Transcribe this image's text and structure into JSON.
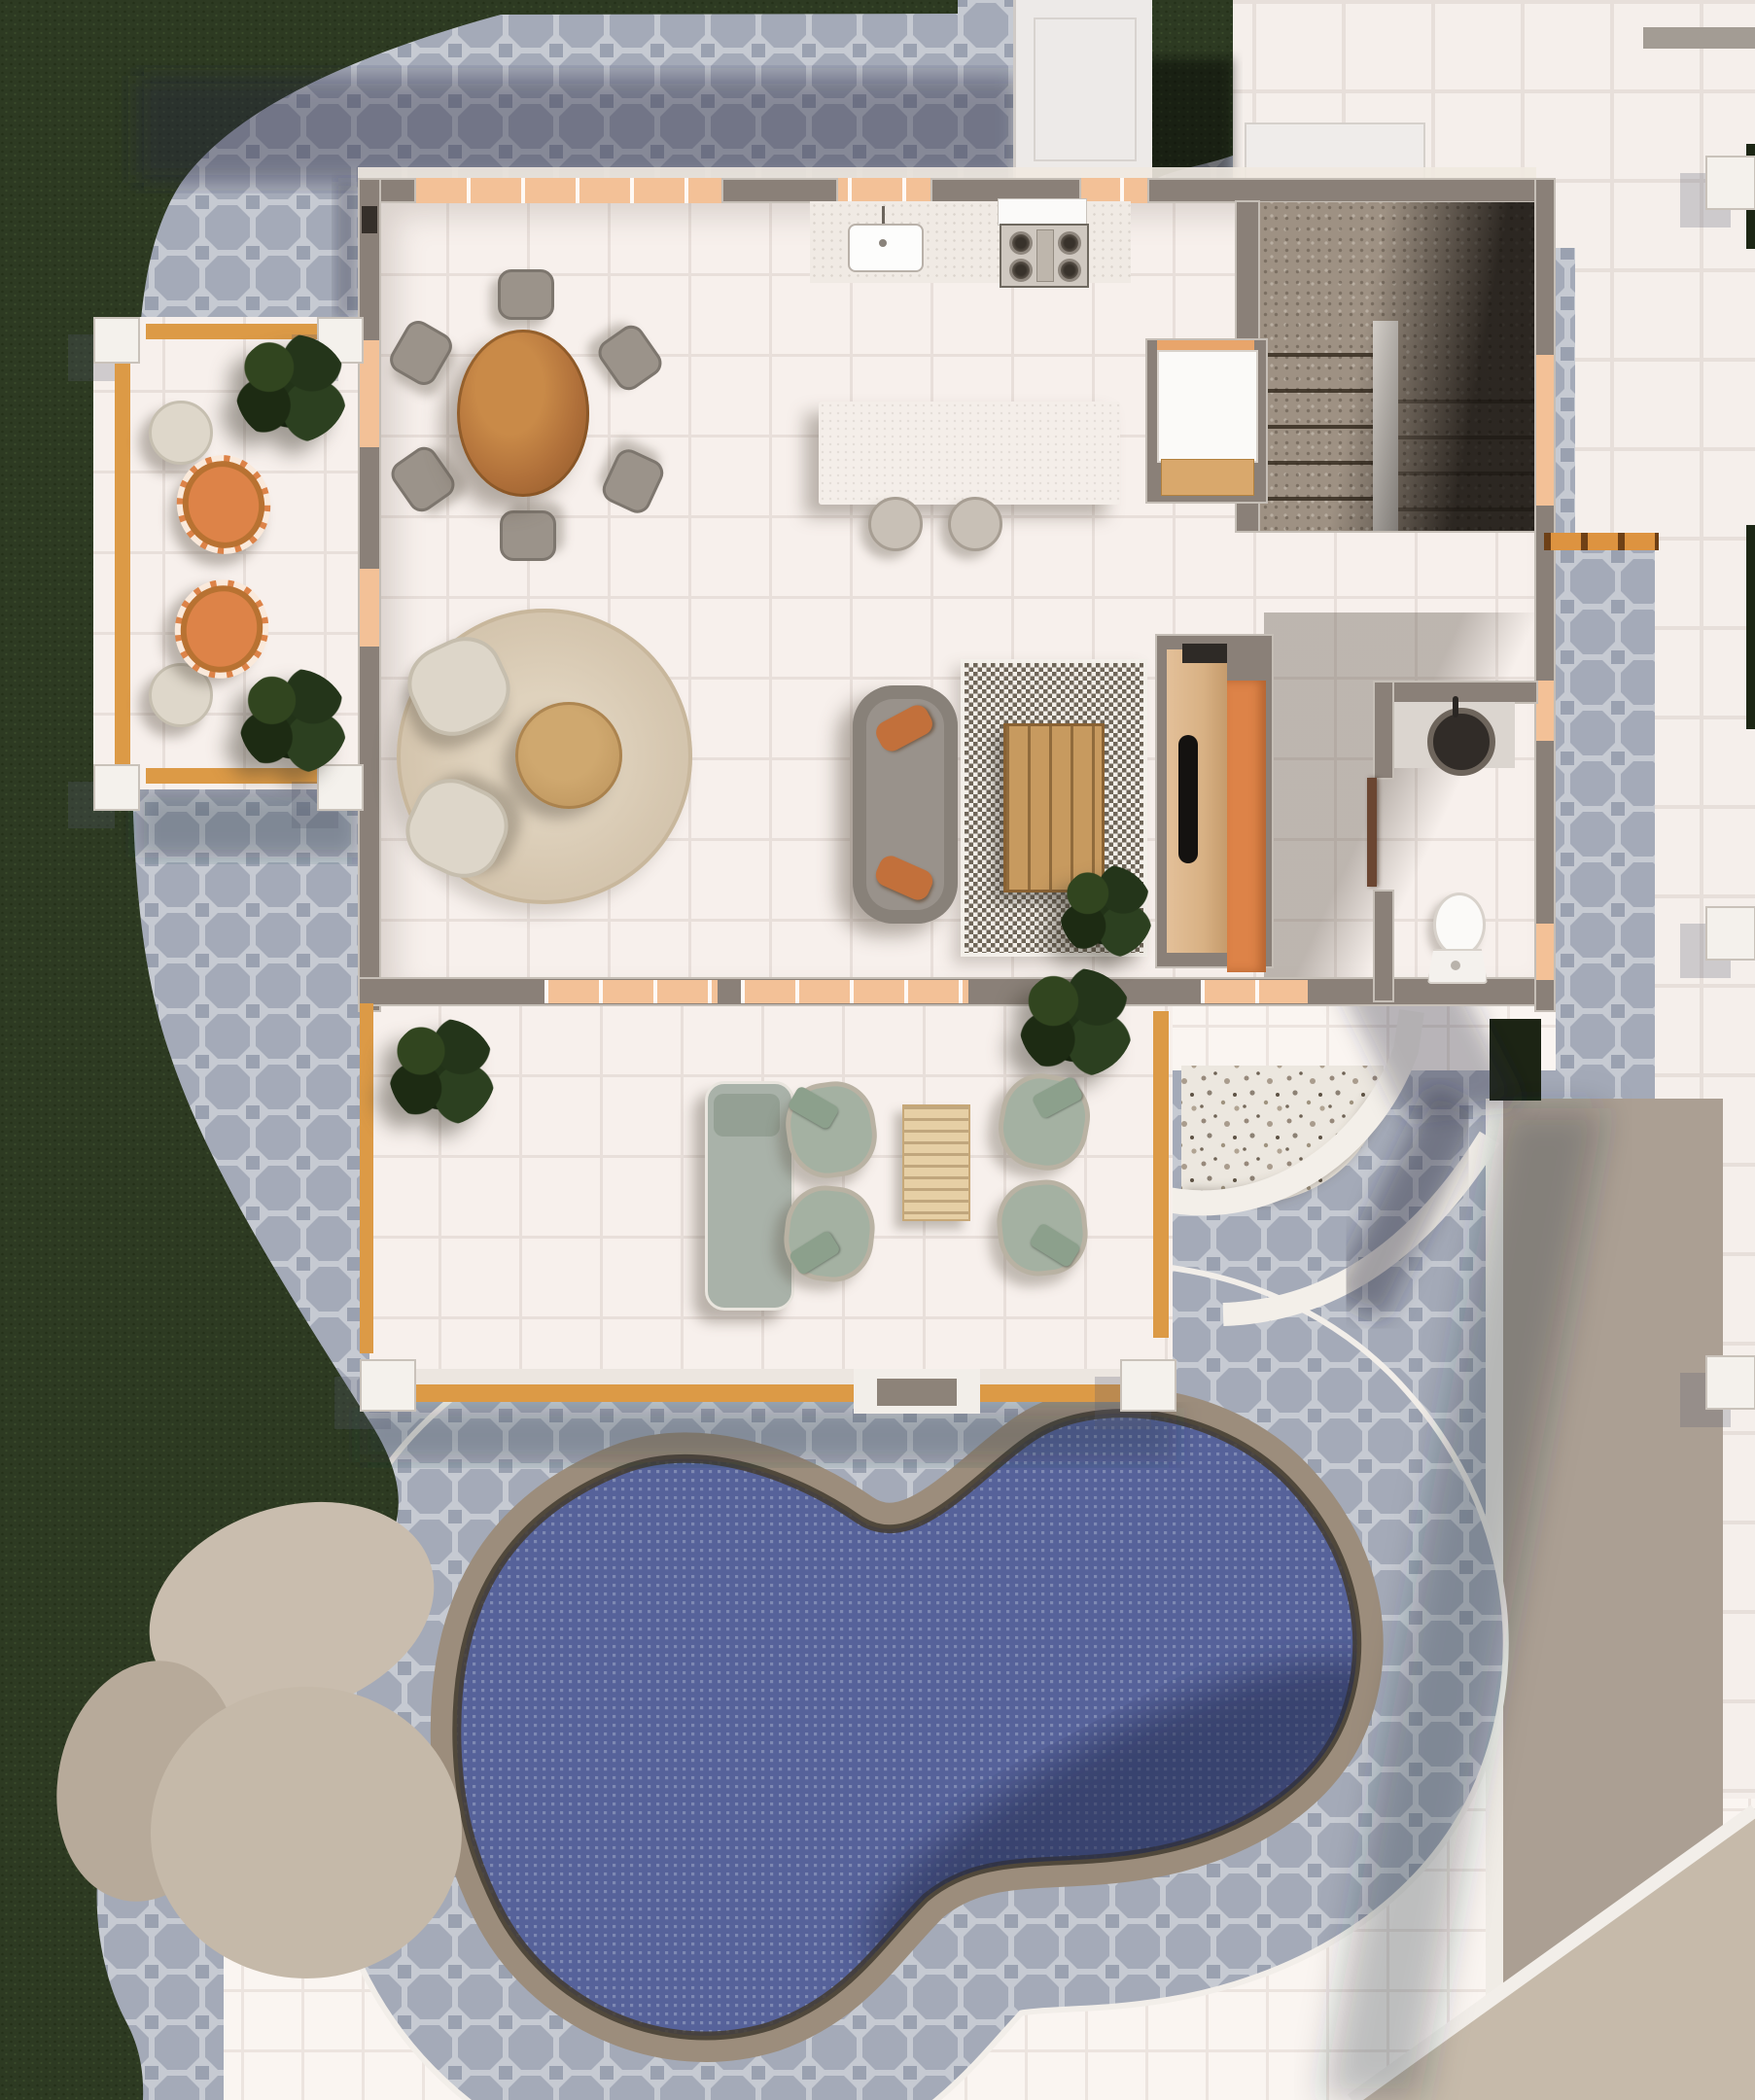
{
  "meta": {
    "type": "architectural-floor-plan-3d-render",
    "view": "top-down",
    "level": "ground-floor"
  },
  "palette": {
    "grass": "#2d3a22",
    "grass_dark": "#1c2614",
    "cobble_gray": "#a4aab8",
    "cobble_grout": "#c6cad2",
    "tile_white": "#f7f0ec",
    "tile_grout": "#e8dfda",
    "tile_out_white": "#faf5f1",
    "wall_gray": "#8a8078",
    "lintel_peach": "#f3c197",
    "accent_orange": "#dd8348",
    "wood_beam": "#dc9a46",
    "table_wood": "#b0703a",
    "light_wood": "#d8b184",
    "water_blue": "#56629a",
    "water_grid": "#7e89b3",
    "coping_tan": "#9c8d7c",
    "carpet_taupe": "#9e9183",
    "sage": "#a4b1a2",
    "cream": "#ddd6c9",
    "rug_beige": "#d8cab4",
    "taupe_band": "#ab9f93",
    "pad_beige": "#c7bbab",
    "terrazzo_bg": "#ece7df"
  },
  "site": {
    "ground_surfaces": [
      "lawn",
      "cobblestone-paver-walkway",
      "white-tile-terrace",
      "white-tile-pool-surround",
      "beige-stepping-pads",
      "taupe-side-path",
      "terrazzo-entry-mat"
    ],
    "pool": {
      "shape": "kidney",
      "water": "#56629a",
      "coping": "#9c8d7c"
    }
  },
  "rooms": [
    {
      "id": "porch",
      "name": "Side porch",
      "furniture": [
        "wicker-chair",
        "wicker-chair",
        "side-table",
        "side-table",
        "potted-plant",
        "potted-plant"
      ]
    },
    {
      "id": "great-room",
      "name": "Open plan kitchen / dining / living",
      "kitchen": [
        "counter",
        "sink",
        "gas-stove",
        "island",
        "stool",
        "stool"
      ],
      "dining": [
        "round-wood-table",
        "chair x6"
      ],
      "living": [
        "sofa",
        "pillow x2",
        "round-rug",
        "armchair x2",
        "round-coffee-table",
        "checkered-rug",
        "slat-coffee-table",
        "media-wall",
        "tv",
        "sliding-orange-door",
        "plant"
      ]
    },
    {
      "id": "stairs",
      "name": "U-shaped carpeted staircase",
      "features": [
        "landing",
        "treads",
        "stringer"
      ]
    },
    {
      "id": "closet",
      "name": "Hall closet",
      "features": [
        "white-door",
        "wood-bench"
      ]
    },
    {
      "id": "powder-room",
      "name": "Powder room",
      "furniture": [
        "vanity",
        "round-basin",
        "toilet",
        "door"
      ]
    },
    {
      "id": "patio",
      "name": "Covered patio",
      "furniture": [
        "sun-lounger",
        "lounge-chair x4",
        "slat-table",
        "potted-plant x2"
      ]
    },
    {
      "id": "terrace",
      "name": "Right side terrace",
      "features": [
        "pergola-posts x3",
        "orange-beam"
      ]
    }
  ]
}
